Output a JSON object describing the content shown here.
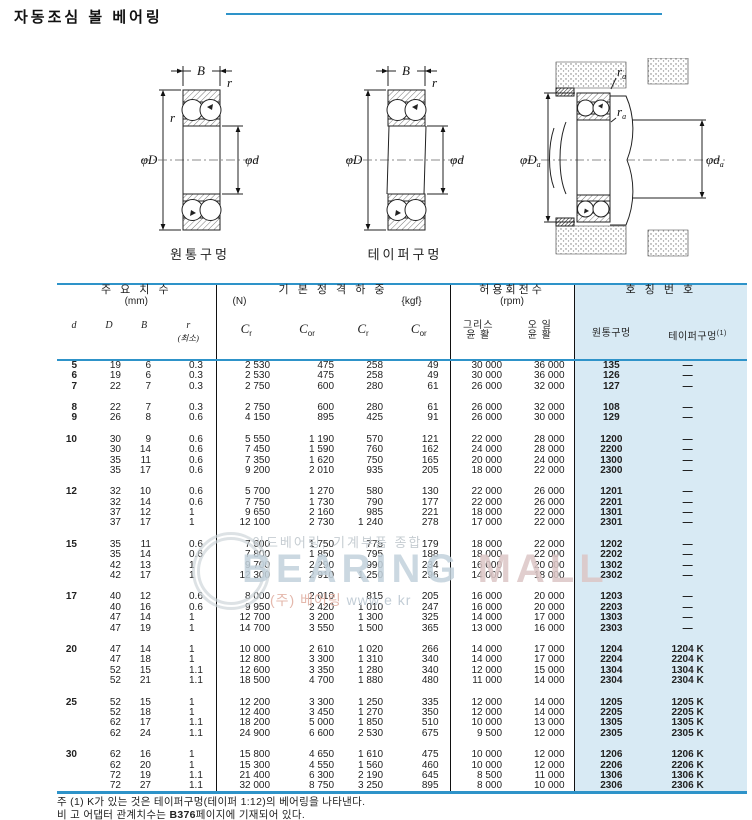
{
  "page": {
    "title": "자동조심 볼 베어링"
  },
  "figures": {
    "cylindrical": {
      "caption": "원통구멍",
      "label_B": "B",
      "label_r_top": "r",
      "label_r_left": "r",
      "label_D": "φD",
      "label_d": "φd"
    },
    "tapered": {
      "caption": "테이퍼구멍",
      "label_B": "B",
      "label_r_top": "r",
      "label_D": "φD",
      "label_d": "φd"
    },
    "mounted": {
      "label_Da_main": "φD",
      "label_Da_sub": "a",
      "label_da_main": "φd",
      "label_da_sub": "a",
      "label_ra1_main": "r",
      "label_ra1_sub": "a",
      "label_ra2_main": "r",
      "label_ra2_sub": "a"
    }
  },
  "table": {
    "sections": {
      "dims": {
        "title": "주 요 치 수",
        "unit": "(mm)"
      },
      "load": {
        "title": "기 본 정 격 하 중",
        "unit_n": "(N)",
        "unit_kgf": "{kgf}"
      },
      "speed": {
        "title": "허용회전수",
        "unit": "(rpm)"
      },
      "number": {
        "title": "호 칭 번 호"
      }
    },
    "columns": {
      "d": "d",
      "D": "D",
      "B": "B",
      "r": "r",
      "r_note": "(최소)",
      "c_main": "C",
      "c_sub_r": "r",
      "c_sub_or": "or",
      "grease_l1": "그리스",
      "grease_l2": "윤 활",
      "oil_l1": "오 일",
      "oil_l2": "윤 활",
      "cyl": "원통구멍",
      "taper": "테이퍼구멍",
      "taper_sup": "(1)"
    },
    "groups": [
      {
        "rows": [
          [
            "5",
            "19",
            "6",
            "0.3",
            "2 530",
            "475",
            "258",
            "49",
            "30 000",
            "36 000",
            "135",
            "—"
          ],
          [
            "6",
            "19",
            "6",
            "0.3",
            "2 530",
            "475",
            "258",
            "49",
            "30 000",
            "36 000",
            "126",
            "—"
          ],
          [
            "7",
            "22",
            "7",
            "0.3",
            "2 750",
            "600",
            "280",
            "61",
            "26 000",
            "32 000",
            "127",
            "—"
          ]
        ]
      },
      {
        "rows": [
          [
            "8",
            "22",
            "7",
            "0.3",
            "2 750",
            "600",
            "280",
            "61",
            "26 000",
            "32 000",
            "108",
            "—"
          ],
          [
            "9",
            "26",
            "8",
            "0.6",
            "4 150",
            "895",
            "425",
            "91",
            "26 000",
            "30 000",
            "129",
            "—"
          ]
        ]
      },
      {
        "rows": [
          [
            "10",
            "30",
            "9",
            "0.6",
            "5 550",
            "1 190",
            "570",
            "121",
            "22 000",
            "28 000",
            "1200",
            "—"
          ],
          [
            "",
            "30",
            "14",
            "0.6",
            "7 450",
            "1 590",
            "760",
            "162",
            "24 000",
            "28 000",
            "2200",
            "—"
          ],
          [
            "",
            "35",
            "11",
            "0.6",
            "7 350",
            "1 620",
            "750",
            "165",
            "20 000",
            "24 000",
            "1300",
            "—"
          ],
          [
            "",
            "35",
            "17",
            "0.6",
            "9 200",
            "2 010",
            "935",
            "205",
            "18 000",
            "22 000",
            "2300",
            "—"
          ]
        ]
      },
      {
        "rows": [
          [
            "12",
            "32",
            "10",
            "0.6",
            "5 700",
            "1 270",
            "580",
            "130",
            "22 000",
            "26 000",
            "1201",
            "—"
          ],
          [
            "",
            "32",
            "14",
            "0.6",
            "7 750",
            "1 730",
            "790",
            "177",
            "22 000",
            "26 000",
            "2201",
            "—"
          ],
          [
            "",
            "37",
            "12",
            "1",
            "9 650",
            "2 160",
            "985",
            "221",
            "18 000",
            "22 000",
            "1301",
            "—"
          ],
          [
            "",
            "37",
            "17",
            "1",
            "12 100",
            "2 730",
            "1 240",
            "278",
            "17 000",
            "22 000",
            "2301",
            "—"
          ]
        ]
      },
      {
        "rows": [
          [
            "15",
            "35",
            "11",
            "0.6",
            "7 600",
            "1 750",
            "775",
            "179",
            "18 000",
            "22 000",
            "1202",
            "—"
          ],
          [
            "",
            "35",
            "14",
            "0.6",
            "7 800",
            "1 850",
            "795",
            "188",
            "18 000",
            "22 000",
            "2202",
            "—"
          ],
          [
            "",
            "42",
            "13",
            "1",
            "9 700",
            "2 290",
            "990",
            "234",
            "16 000",
            "20 000",
            "1302",
            "—"
          ],
          [
            "",
            "42",
            "17",
            "1",
            "12 300",
            "2 910",
            "1 250",
            "296",
            "14 000",
            "18 000",
            "2302",
            "—"
          ]
        ]
      },
      {
        "rows": [
          [
            "17",
            "40",
            "12",
            "0.6",
            "8 000",
            "2 010",
            "815",
            "205",
            "16 000",
            "20 000",
            "1203",
            "—"
          ],
          [
            "",
            "40",
            "16",
            "0.6",
            "9 950",
            "2 420",
            "1 010",
            "247",
            "16 000",
            "20 000",
            "2203",
            "—"
          ],
          [
            "",
            "47",
            "14",
            "1",
            "12 700",
            "3 200",
            "1 300",
            "325",
            "14 000",
            "17 000",
            "1303",
            "—"
          ],
          [
            "",
            "47",
            "19",
            "1",
            "14 700",
            "3 550",
            "1 500",
            "365",
            "13 000",
            "16 000",
            "2303",
            "—"
          ]
        ]
      },
      {
        "rows": [
          [
            "20",
            "47",
            "14",
            "1",
            "10 000",
            "2 610",
            "1 020",
            "266",
            "14 000",
            "17 000",
            "1204",
            "1204 K"
          ],
          [
            "",
            "47",
            "18",
            "1",
            "12 800",
            "3 300",
            "1 310",
            "340",
            "14 000",
            "17 000",
            "2204",
            "2204 K"
          ],
          [
            "",
            "52",
            "15",
            "1.1",
            "12 600",
            "3 350",
            "1 280",
            "340",
            "12 000",
            "15 000",
            "1304",
            "1304 K"
          ],
          [
            "",
            "52",
            "21",
            "1.1",
            "18 500",
            "4 700",
            "1 880",
            "480",
            "11 000",
            "14 000",
            "2304",
            "2304 K"
          ]
        ]
      },
      {
        "rows": [
          [
            "25",
            "52",
            "15",
            "1",
            "12 200",
            "3 300",
            "1 250",
            "335",
            "12 000",
            "14 000",
            "1205",
            "1205 K"
          ],
          [
            "",
            "52",
            "18",
            "1",
            "12 400",
            "3 450",
            "1 270",
            "350",
            "12 000",
            "14 000",
            "2205",
            "2205 K"
          ],
          [
            "",
            "62",
            "17",
            "1.1",
            "18 200",
            "5 000",
            "1 850",
            "510",
            "10 000",
            "13 000",
            "1305",
            "1305 K"
          ],
          [
            "",
            "62",
            "24",
            "1.1",
            "24 900",
            "6 600",
            "2 530",
            "675",
            "9 500",
            "12 000",
            "2305",
            "2305 K"
          ]
        ]
      },
      {
        "rows": [
          [
            "30",
            "62",
            "16",
            "1",
            "15 800",
            "4 650",
            "1 610",
            "475",
            "10 000",
            "12 000",
            "1206",
            "1206 K"
          ],
          [
            "",
            "62",
            "20",
            "1",
            "15 300",
            "4 550",
            "1 560",
            "460",
            "10 000",
            "12 000",
            "2206",
            "2206 K"
          ],
          [
            "",
            "72",
            "19",
            "1.1",
            "21 400",
            "6 300",
            "2 190",
            "645",
            "8 500",
            "11 000",
            "1306",
            "1306 K"
          ],
          [
            "",
            "72",
            "27",
            "1.1",
            "32 000",
            "8 750",
            "3 250",
            "895",
            "8 000",
            "10 000",
            "2306",
            "2306 K"
          ]
        ]
      }
    ]
  },
  "notes": {
    "note1": "주 (1) K가 있는 것은 테이퍼구멍(테이퍼 1:12)의 베어링을 나타낸다.",
    "note2_prefix": "비 고 어댑터 관계치수는 ",
    "note2_bold": "B376",
    "note2_suffix": "페이지에 기재되어 있다."
  },
  "watermark": {
    "line1": "이드베어링, 기계부품 종합",
    "brand_1": "BEARING",
    "brand_2": "MALL",
    "line2_a": "(주) 베어링",
    "line2_b": "www.e   kr"
  }
}
